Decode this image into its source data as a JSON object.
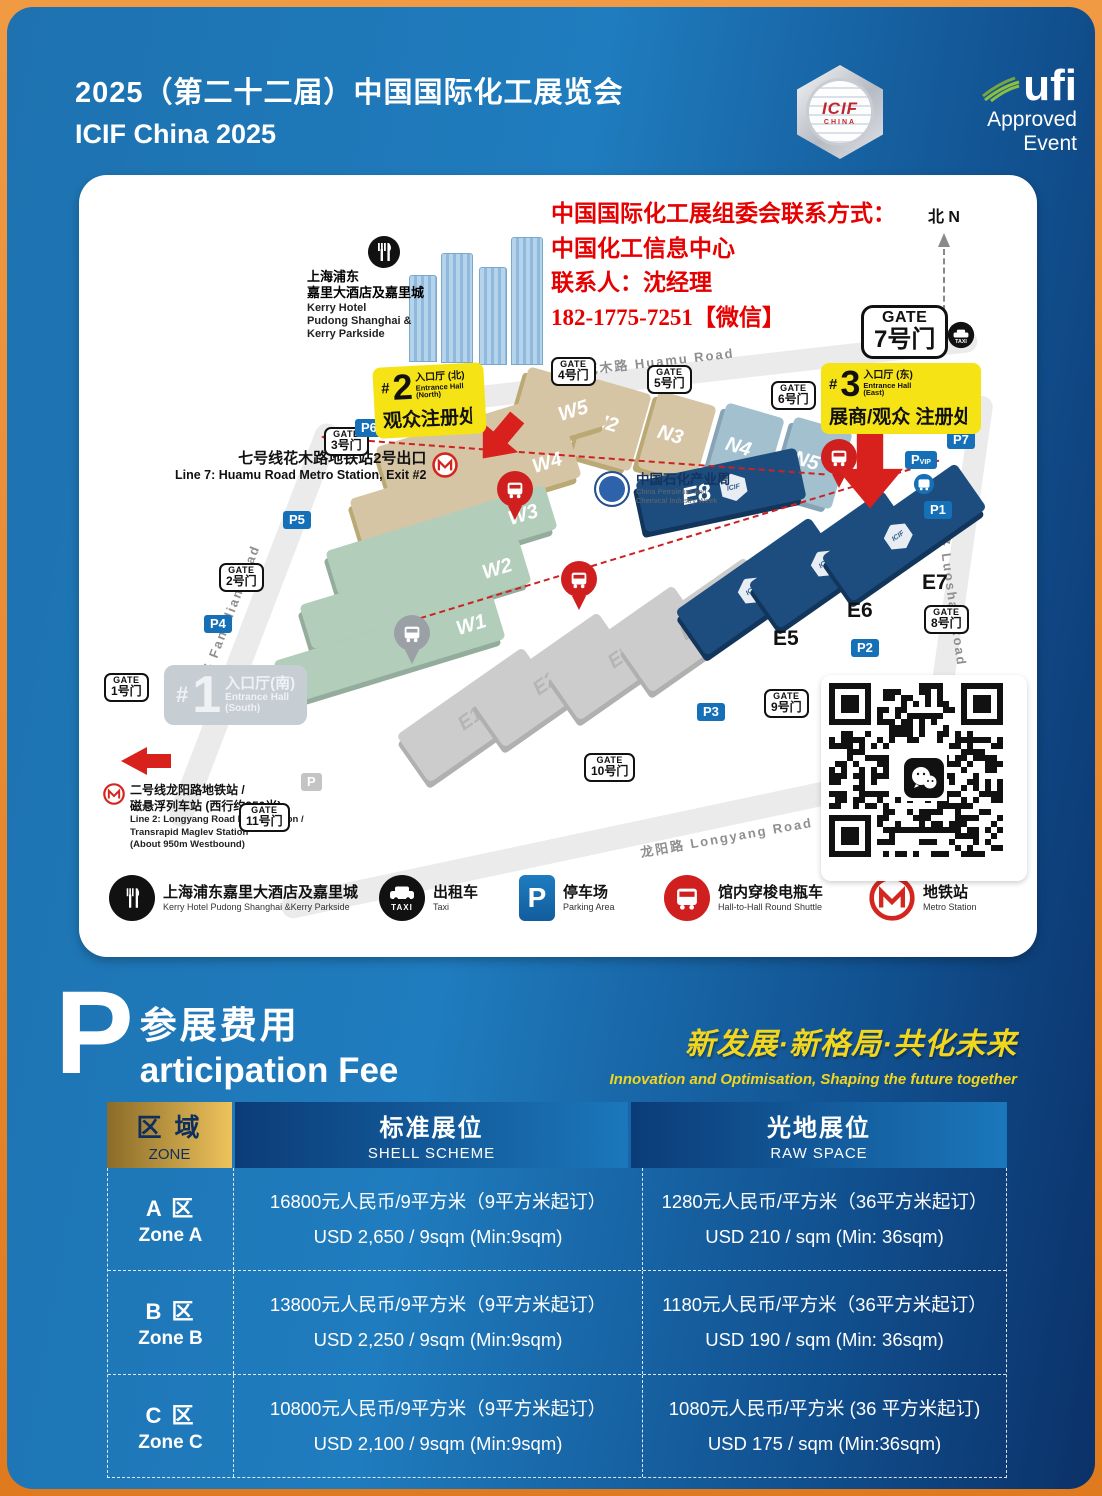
{
  "header": {
    "title_cn": "2025（第二十二届）中国国际化工展览会",
    "title_en": "ICIF China 2025",
    "icif": {
      "name": "ICIF",
      "sub": "CHINA"
    },
    "ufi": {
      "name": "ufi",
      "line1": "Approved",
      "line2": "Event"
    }
  },
  "map": {
    "contact": {
      "line1": "中国国际化工展组委会联系方式：",
      "line2": "中国化工信息中心",
      "line3": "联系人：沈经理",
      "line4": "182-1775-7251【微信】"
    },
    "compass": "北 N",
    "roads": {
      "north": "花木路  Huamu Road",
      "west": "芳甸路  Fangdian Road",
      "east": "罗山路  Luoshan Road",
      "south": "龙阳路  Longyang Road"
    },
    "hotel": {
      "cn1": "上海浦东",
      "cn2": "嘉里大酒店及嘉里城",
      "en1": "Kerry Hotel",
      "en2": "Pudong Shanghai &",
      "en3": "Kerry Parkside"
    },
    "line7": {
      "cn": "七号线花木路地铁站2号出口",
      "en": "Line 7: Huamu Road Metro Station, Exit #2"
    },
    "line2": {
      "cn1": "二号线龙阳路地铁站 /",
      "cn2": "磁悬浮列车站 (西行约950米)",
      "en1": "Line 2: Longyang Road Metro Station /",
      "en2": "Transrapid Maglev Station",
      "en3": "(About 950m Westbound)"
    },
    "entrance1": {
      "hash": "#",
      "num": "1",
      "cn": "入口厅(南)",
      "en1": "Entrance Hall",
      "en2": "(South)"
    },
    "entrance2": {
      "hash": "#",
      "num": "2",
      "cn": "入口厅 (北)",
      "en1": "Entrance Hall",
      "en2": "(North)",
      "sub": "观众注册处"
    },
    "entrance3": {
      "hash": "#",
      "num": "3",
      "cn": "入口厅 (东)",
      "en1": "Entrance Hall",
      "en2": "(East)",
      "sub": "展商/观众 注册处"
    },
    "gate7": {
      "top": "GATE",
      "num": "7号门"
    },
    "gates": [
      {
        "top": "GATE",
        "num": "1号门"
      },
      {
        "top": "GATE",
        "num": "2号门"
      },
      {
        "top": "GATE",
        "num": "3号门"
      },
      {
        "top": "GATE",
        "num": "4号门"
      },
      {
        "top": "GATE",
        "num": "5号门"
      },
      {
        "top": "GATE",
        "num": "6号门"
      },
      {
        "top": "GATE",
        "num": "8号门"
      },
      {
        "top": "GATE",
        "num": "9号门"
      },
      {
        "top": "GATE",
        "num": "10号门"
      },
      {
        "top": "GATE",
        "num": "11号门"
      }
    ],
    "parking": {
      "p1": "P1",
      "p2": "P2",
      "p3": "P3",
      "p4": "P4",
      "p5": "P5",
      "p6": "P6",
      "p7": "P7",
      "vip": "P",
      "vip_sub": "VIP",
      "gray": "P",
      "p_letter": "P"
    },
    "halls": {
      "n": [
        "N1",
        "N2",
        "N3",
        "N4",
        "N5"
      ],
      "w": [
        "W5",
        "W4",
        "W3",
        "W2",
        "W1"
      ],
      "e": [
        "E1",
        "E2",
        "E3",
        "E4"
      ],
      "eb": [
        "E5",
        "E6",
        "E7",
        "E8"
      ]
    },
    "pcw": {
      "cn": "中国石化产业周",
      "en1": "China Petroleum and",
      "en2": "Chemical Industry Week"
    },
    "badge": "ICIF",
    "taxi_label": "TAXI",
    "legend": [
      {
        "cn": "上海浦东嘉里大酒店及嘉里城",
        "en": "Kerry Hotel Pudong Shanghai &Kerry Parkside"
      },
      {
        "cn": "出租车",
        "en": "Taxi"
      },
      {
        "cn": "停车场",
        "en": "Parking Area"
      },
      {
        "cn": "馆内穿梭电瓶车",
        "en": "Hall-to-Hall Round Shuttle"
      },
      {
        "cn": "地铁站",
        "en": "Metro Station"
      }
    ]
  },
  "fee": {
    "p": "P",
    "cn": "参展费用",
    "en": "articipation Fee",
    "slogan_cn": "新发展·新格局·共化未来",
    "slogan_en": "Innovation and Optimisation, Shaping the future together"
  },
  "table": {
    "zone_cn": "区 域",
    "zone_en": "ZONE",
    "shell_cn": "标准展位",
    "shell_en": "SHELL SCHEME",
    "raw_cn": "光地展位",
    "raw_en": "RAW SPACE",
    "rows": [
      {
        "zone_cn": "A 区",
        "zone_en": "Zone A",
        "shell_cn": "16800元人民币/9平方米（9平方米起订）",
        "shell_en": "USD  2,650 / 9sqm (Min:9sqm)",
        "raw_cn": "1280元人民币/平方米（36平方米起订）",
        "raw_en": "USD  210 / sqm (Min: 36sqm)"
      },
      {
        "zone_cn": "B 区",
        "zone_en": "Zone B",
        "shell_cn": "13800元人民币/9平方米（9平方米起订）",
        "shell_en": "USD  2,250 / 9sqm (Min:9sqm)",
        "raw_cn": "1180元人民币/平方米（36平方米起订）",
        "raw_en": "USD  190 / sqm (Min: 36sqm)"
      },
      {
        "zone_cn": "C 区",
        "zone_en": "Zone C",
        "shell_cn": "10800元人民币/9平方米（9平方米起订）",
        "shell_en": "USD  2,100 / 9sqm (Min:9sqm)",
        "raw_cn": "1080元人民币/平方米 (36 平方米起订)",
        "raw_en": "USD  175 / sqm (Min:36sqm)"
      }
    ]
  }
}
